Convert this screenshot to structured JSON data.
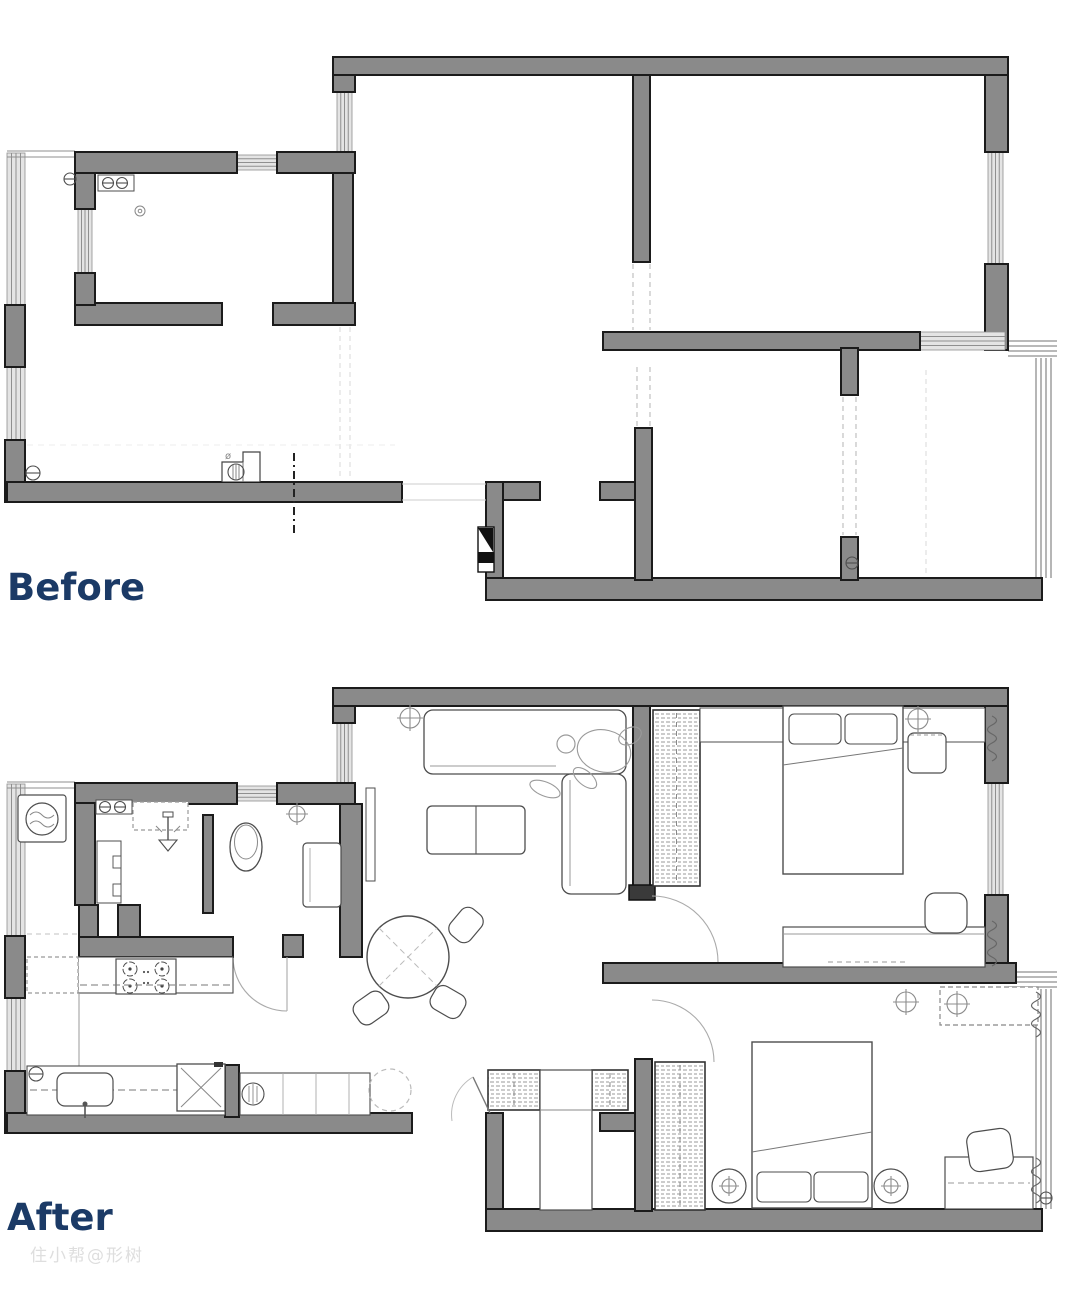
{
  "labels": {
    "before": "Before",
    "after": "After"
  },
  "watermark": "住小帮@形树",
  "palette": {
    "wall_fill": "#8a8a8a",
    "wall_outline": "#1b1b1b",
    "window_fill": "#e4e4e4",
    "window_line": "#8f8f8f",
    "furniture_line": "#4d4d4d",
    "light_furniture_line": "#8c8c8c",
    "dash_line": "#c0c0c0",
    "ghost_line": "#dcdcdc",
    "label_color": "#1b3a66",
    "watermark_color": "#dedede",
    "paper": "#ffffff"
  },
  "plans": [
    {
      "id": "before",
      "title": "Before",
      "fixtures": [
        "kitchen-sink",
        "ceiling-rose",
        "toilet",
        "entry-door-mark",
        "radiator-valve"
      ]
    },
    {
      "id": "after",
      "title": "After",
      "fixtures": [
        "washing-machine",
        "bath-sink",
        "shower-head",
        "toilet",
        "vanity",
        "gas-stove",
        "kitchen-sink",
        "fridge",
        "sofa",
        "person-figure",
        "coffee-table",
        "dining-table",
        "dining-chairs",
        "tv-bench",
        "shoe-cabinets",
        "wardrobe",
        "double-bed",
        "bedside-table",
        "desk",
        "desk-chair",
        "radiator",
        "ceiling-light"
      ]
    }
  ]
}
